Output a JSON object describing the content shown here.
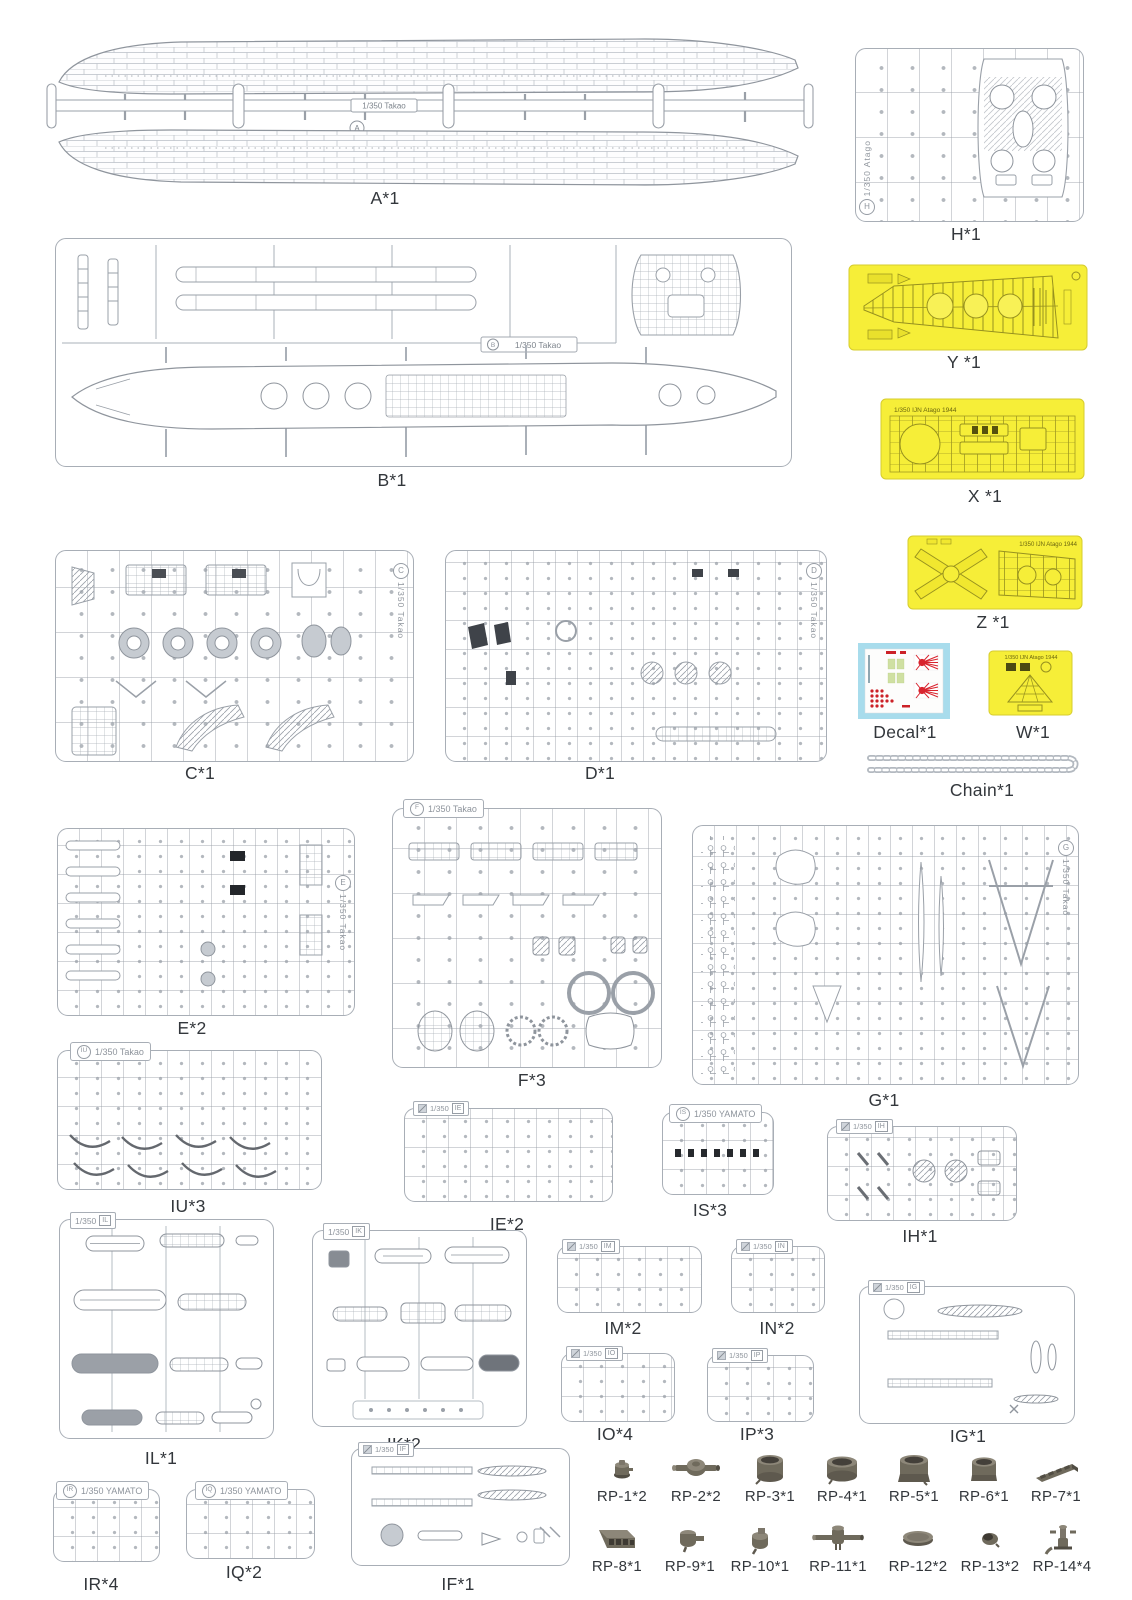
{
  "sprues": {
    "A": {
      "badge": "A",
      "scale": "1/350 Takao",
      "label": "A*1"
    },
    "B": {
      "badge": "B",
      "scale": "1/350 Takao",
      "label": "B*1"
    },
    "C": {
      "badge": "C",
      "scale": "1/350 Takao",
      "label": "C*1"
    },
    "D": {
      "badge": "D",
      "scale": "1/350 Takao",
      "label": "D*1"
    },
    "E": {
      "badge": "E",
      "scale": "1/350 Takao",
      "label": "E*2"
    },
    "F": {
      "badge": "F",
      "scale": "1/350 Takao",
      "label": "F*3"
    },
    "G": {
      "badge": "G",
      "scale": "1/350 Takao",
      "label": "G*1"
    },
    "H": {
      "badge": "H",
      "scale": "1/350 Atago",
      "label": "H*1"
    },
    "IU": {
      "badge": "IU",
      "scale": "1/350 Takao",
      "label": "IU*3"
    },
    "IE": {
      "badge": "IE",
      "scale": "1/350",
      "label": "IE*2"
    },
    "IS": {
      "badge": "IS",
      "scale": "1/350 YAMATO",
      "label": "IS*3"
    },
    "IH": {
      "badge": "IH",
      "scale": "1/350",
      "label": "IH*1"
    },
    "IL": {
      "badge": "IL",
      "scale": "1/350",
      "label": "IL*1"
    },
    "IK": {
      "badge": "IK",
      "scale": "1/350",
      "label": "IK*2"
    },
    "IM": {
      "badge": "IM",
      "scale": "1/350",
      "label": "IM*2"
    },
    "IN": {
      "badge": "IN",
      "scale": "1/350",
      "label": "IN*2"
    },
    "IG": {
      "badge": "IG",
      "scale": "1/350",
      "label": "IG*1"
    },
    "IO": {
      "badge": "IO",
      "scale": "1/350",
      "label": "IO*4"
    },
    "IP": {
      "badge": "IP",
      "scale": "1/350",
      "label": "IP*3"
    },
    "IR": {
      "badge": "IR",
      "scale": "1/350 YAMATO",
      "label": "IR*4"
    },
    "IQ": {
      "badge": "IQ",
      "scale": "1/350 YAMATO",
      "label": "IQ*2"
    },
    "IF": {
      "badge": "IF",
      "scale": "1/350",
      "label": "IF*1"
    }
  },
  "photo_etch": {
    "Y": {
      "label": "Y *1"
    },
    "X": {
      "label": "X *1",
      "header": "1/350 IJN Atago 1944"
    },
    "Z": {
      "label": "Z *1",
      "header": "1/350 IJN Atago 1944"
    },
    "W": {
      "label": "W*1",
      "header": "1/350 IJN Atago 1944"
    }
  },
  "decal": {
    "label": "Decal*1"
  },
  "chain": {
    "label": "Chain*1"
  },
  "rp_parts": [
    {
      "label": "RP-1*2"
    },
    {
      "label": "RP-2*2"
    },
    {
      "label": "RP-3*1"
    },
    {
      "label": "RP-4*1"
    },
    {
      "label": "RP-5*1"
    },
    {
      "label": "RP-6*1"
    },
    {
      "label": "RP-7*1"
    },
    {
      "label": "RP-8*1"
    },
    {
      "label": "RP-9*1"
    },
    {
      "label": "RP-10*1"
    },
    {
      "label": "RP-11*1"
    },
    {
      "label": "RP-12*2"
    },
    {
      "label": "RP-13*2"
    },
    {
      "label": "RP-14*4"
    }
  ],
  "colors": {
    "pe_sheet": "#f6ee38",
    "pe_line": "#97911f",
    "decal_bg": "#a8dcec",
    "metal_part": "#6f6a5c",
    "sprue_line": "#a8aeb6"
  }
}
